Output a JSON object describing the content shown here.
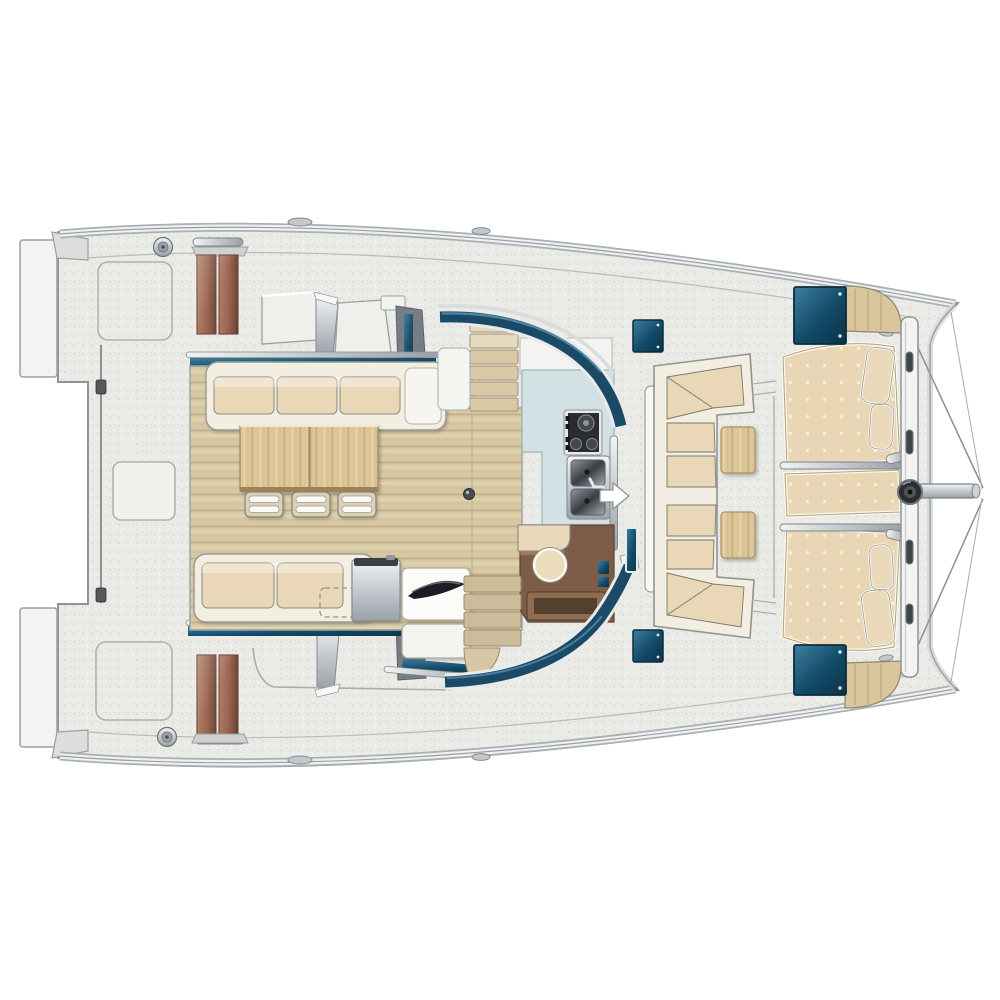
{
  "diagram": {
    "title": "Catamaran saloon and deck floor plan (top view)",
    "type": "boat-floor-plan",
    "orientation": "bow-right-stern-left"
  },
  "palette": {
    "bg": "#ffffff",
    "deck_base": "#eaeae6",
    "speckle_dark": "#d6d6d1",
    "speckle_light": "#f7f7f4",
    "hull_white": "#f3f3f1",
    "outline_gray": "#8e949a",
    "seam_gray": "#b2b2ab",
    "rail_light": "#eff1f1",
    "rail_dark": "#a9afb5",
    "wood_floor": "#d7c9a4",
    "wood_line": "#bfae87",
    "wood_streak": "#e4d8b7",
    "table_wood": "#dcc697",
    "table_grain": "#c0a473",
    "cushion": "#e9d7b7",
    "cushion_frame": "#f2eee2",
    "sunpad": "#e8d6b5",
    "sunpad_dot": "#f7eedb",
    "pillow": "#ead9ba",
    "hatch_navy": "#124a67",
    "hatch_navy_light": "#3d7fa2",
    "window_navy": "#1a4a66",
    "window_highlight": "#5e96b5",
    "steps_brown": "#9c634e",
    "steps_brown_dark": "#6f4334",
    "bar_brown": "#7d5c48",
    "drawer_brown": "#8f6c52",
    "drawer_inset": "#54402f",
    "counter_blue": "#d3e0e4",
    "stove_dark": "#2a2c2e",
    "burner_gray": "#43484c",
    "sink_steel": "#646c73",
    "metal_light": "#f2f4f4",
    "metal_mid": "#b7bdc2",
    "metal_dark": "#7d838a",
    "dark_wall": "#767d85",
    "arrow_white": "#ffffff",
    "stool_cream": "#ecdcbc",
    "stairs_up": "#d9c8a6",
    "stairs_down": "#cdbc9a",
    "fitting_dark": "#2b2e31"
  },
  "elements": {
    "hull_port": "port hull (top)",
    "hull_starboard": "starboard hull (bottom)",
    "transom_platforms": "aft swim platforms",
    "companionway_steps": "teak companionway steps to hull cabins",
    "saloon_floor": "open saloon / cockpit teak sole",
    "aft_settee": "aft bench settee with 3 cushions",
    "dinette_table": "two-leaf dinette table",
    "dinette_chairs": "3 folding chairs",
    "side_sofa": "lounge sofa with 2 cushions",
    "fridge_drawers": "refrigerator drawer unit",
    "galley_counter": "galley worktop",
    "stove": "3-burner stove",
    "sink": "double sink with faucet",
    "entry_door_arrow": "door opening direction arrow",
    "nav_stool": "round stool at chart desk",
    "chart_desk": "chart desk with drawer",
    "window_band": "wraparound saloon windshield",
    "forward_cockpit_bench": "forward cockpit U-settee",
    "cocktail_tables": "2 teak cocktail tables",
    "sunpads": "foredeck sunbathing cushions with pillows",
    "deck_hatches": "4 flush deck hatches",
    "forward_crossbeam": "forward crossbeam with bridle and bowsprit",
    "winches_cleats": "winches and mooring cleats",
    "lifeline": "side-deck lifeline"
  }
}
